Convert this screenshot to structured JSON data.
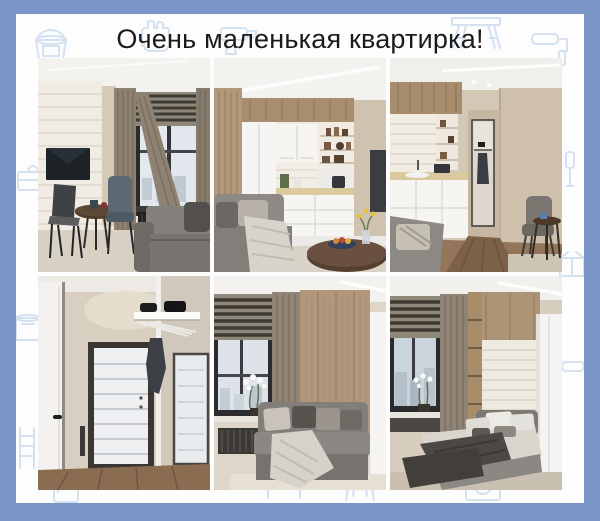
{
  "page": {
    "title": "Очень маленькая квартирка!"
  },
  "collage": {
    "photos": [
      {
        "id": "living-room-tv",
        "alt": "Living room: white brick wall with wall-mounted TV, small round table with two chairs, window with striped roman blind and taupe curtains, black radiator, grey sofa"
      },
      {
        "id": "kitchen-corner",
        "alt": "Small white kitchen with wood panels, open shelves with jars, grey sofa with knit throw and round dark-wood dining table with fruit bowl and yellow flowers"
      },
      {
        "id": "kitchen-to-hallway",
        "alt": "View from white kitchen with sink and pot toward hallway with mirror and hanging jacket, grey armchair with round side table"
      },
      {
        "id": "entry-hallway",
        "alt": "Entry hall: white interior door, white front door in dark frame, white shelf with black boxes and hanging dark jacket, mirrored wardrobe, wood floor"
      },
      {
        "id": "living-room-sofa",
        "alt": "Living room: grey sofa with cushions and throw against wood panel wall, window with dark striped blind, white orchid on the sill, white cabinet"
      },
      {
        "id": "bedroom",
        "alt": "Bedroom: upholstered grey bed with pillows and dark throw, white brick niche in wood wall, white wardrobe, window with dark blind and orchid"
      }
    ]
  },
  "decor": {
    "doodle_icons": [
      "paint-bucket",
      "work-glove",
      "power-drill",
      "sawhorse",
      "paint-roller",
      "toolbox",
      "paint-can",
      "ladder",
      "screwdriver",
      "cardboard-box",
      "fridge",
      "washing-machine",
      "wall-shelf",
      "step-stool"
    ]
  },
  "theme": {
    "border_color": "#7b95c6",
    "panel_color": "#fdfdfd",
    "doodle_color": "#d3e1f0",
    "title_color": "#1b1b1b"
  }
}
